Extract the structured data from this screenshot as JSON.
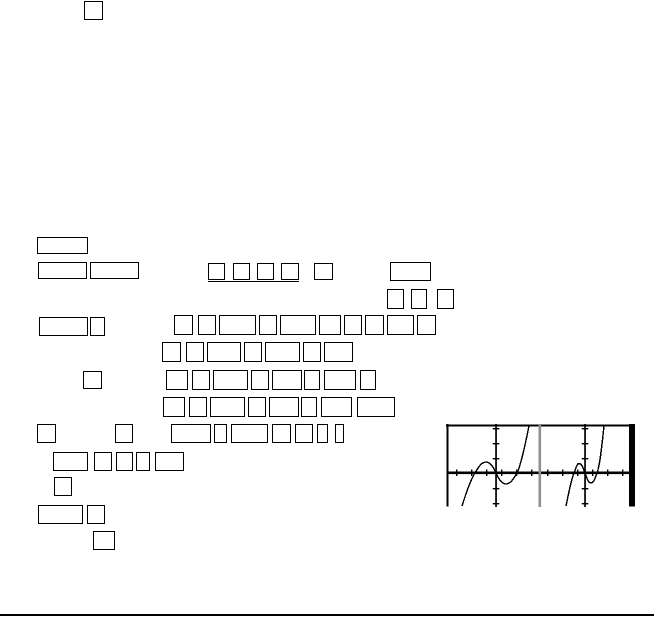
{
  "page": {
    "width": 654,
    "height": 619,
    "background": "#ffffff",
    "ink_color": "#000000"
  },
  "glyph_boxes": [
    [
      84,
      1,
      19,
      19
    ],
    [
      37,
      237,
      51,
      17
    ],
    [
      38,
      262,
      49,
      17
    ],
    [
      90,
      262,
      49,
      17
    ],
    [
      208,
      263,
      17,
      17
    ],
    [
      233,
      263,
      17,
      17
    ],
    [
      257,
      263,
      17,
      17
    ],
    [
      281,
      263,
      18,
      17
    ],
    [
      314,
      263,
      19,
      17
    ],
    [
      390,
      262,
      41,
      19
    ],
    [
      387,
      289,
      17,
      20
    ],
    [
      411,
      289,
      16,
      20
    ],
    [
      437,
      289,
      17,
      20
    ],
    [
      39,
      317,
      49,
      19
    ],
    [
      90,
      317,
      15,
      19
    ],
    [
      174,
      315,
      19,
      20
    ],
    [
      198,
      315,
      18,
      20
    ],
    [
      219,
      315,
      37,
      20
    ],
    [
      259,
      315,
      18,
      20
    ],
    [
      280,
      315,
      36,
      20
    ],
    [
      319,
      315,
      22,
      20
    ],
    [
      344,
      315,
      18,
      20
    ],
    [
      365,
      315,
      19,
      20
    ],
    [
      387,
      315,
      27,
      20
    ],
    [
      417,
      315,
      19,
      20
    ],
    [
      162,
      342,
      19,
      20
    ],
    [
      186,
      342,
      18,
      20
    ],
    [
      207,
      342,
      34,
      20
    ],
    [
      244,
      342,
      18,
      20
    ],
    [
      265,
      342,
      35,
      20
    ],
    [
      303,
      342,
      18,
      20
    ],
    [
      324,
      342,
      29,
      20
    ],
    [
      83,
      371,
      19,
      18
    ],
    [
      166,
      370,
      22,
      20
    ],
    [
      192,
      370,
      18,
      20
    ],
    [
      213,
      370,
      35,
      20
    ],
    [
      251,
      370,
      18,
      20
    ],
    [
      272,
      370,
      30,
      20
    ],
    [
      304,
      370,
      16,
      20
    ],
    [
      324,
      370,
      32,
      20
    ],
    [
      360,
      370,
      16,
      20
    ],
    [
      163,
      397,
      22,
      20
    ],
    [
      189,
      397,
      18,
      20
    ],
    [
      210,
      397,
      35,
      20
    ],
    [
      248,
      397,
      18,
      20
    ],
    [
      269,
      397,
      30,
      20
    ],
    [
      301,
      397,
      16,
      20
    ],
    [
      321,
      397,
      31,
      20
    ],
    [
      357,
      397,
      38,
      20
    ],
    [
      37,
      424,
      19,
      19
    ],
    [
      115,
      424,
      18,
      19
    ],
    [
      171,
      424,
      40,
      19
    ],
    [
      214,
      424,
      13,
      19
    ],
    [
      231,
      424,
      37,
      19
    ],
    [
      272,
      424,
      19,
      19
    ],
    [
      295,
      424,
      18,
      19
    ],
    [
      317,
      424,
      11,
      19
    ],
    [
      335,
      424,
      9,
      19
    ],
    [
      53,
      452,
      35,
      19
    ],
    [
      94,
      452,
      18,
      19
    ],
    [
      116,
      452,
      17,
      19
    ],
    [
      136,
      452,
      14,
      19
    ],
    [
      155,
      452,
      29,
      19
    ],
    [
      54,
      477,
      18,
      19
    ],
    [
      38,
      505,
      45,
      19
    ],
    [
      87,
      505,
      18,
      19
    ],
    [
      93,
      531,
      22,
      19
    ]
  ],
  "underline": {
    "x": 208,
    "y": 280.6,
    "w": 91,
    "h": 1.4
  },
  "footer_rule": {
    "x": 0,
    "y": 614,
    "w": 654,
    "h": 2.2
  },
  "graph": {
    "x": 446,
    "y": 424,
    "w": 190,
    "h": 83,
    "ink": "#000000",
    "separator_color": "#8f8f8f",
    "frame": {
      "top": {
        "x": 0,
        "y": 0.5,
        "w": 189,
        "h": 2
      },
      "left": {
        "x": 0.5,
        "y": 0,
        "w": 2,
        "h": 82.5
      },
      "right_bar": {
        "x": 183,
        "y": 0,
        "w": 6,
        "h": 82.5
      }
    },
    "x_axis": {
      "x": 1,
      "y": 47.5,
      "w": 182,
      "h": 2.6,
      "ticks_x": [
        10,
        25,
        40,
        55,
        70,
        85,
        101,
        116,
        131,
        146,
        161,
        176
      ],
      "tick_y": 45.5,
      "tick_w": 1.4,
      "tick_h": 6.5
    },
    "y_axes": [
      {
        "x": 49.2
      },
      {
        "x": 138.2
      }
    ],
    "y_axis_w": 1.7,
    "y_ticks": {
      "ys": [
        4,
        19,
        34,
        64,
        79
      ],
      "w": 6.6,
      "h": 1.4
    },
    "separator": {
      "x": 92.5,
      "w": 2.6
    },
    "curve_stroke_w": 1.4,
    "curves": [
      "M16,82 C21,66 25,55 29,49 C33,42 36,38 40,38 C44,38 47,42 50,49 C53,56 56,60 60,60 C64,60 67,56 71,49 C75,41 79,22 83,2",
      "M120,82 C123,68 125,56 128,49 C130,44 131,39.5 133,39.5 C136,39.5 137,44 139,49 C141,54 142,59 145,59 C148,59 149,54 151,49 C154,42 156,20 158,2"
    ]
  },
  "chart_data": {
    "type": "line",
    "title": "",
    "xlabel": "",
    "ylabel": "",
    "legend": "none",
    "note": "Two unlabeled calculator-style cubic curves sharing one thick horizontal axis; two vertical axes with tick marks (1-unit spacing), a gray separator line between the panels, thick black right edge; bottom of image clipped.",
    "series": [
      {
        "name": "left-cubic",
        "x_intercepts_ticks": [
          -1.5,
          0,
          1.4
        ],
        "local_max_ticks": [
          -0.75,
          0.7
        ],
        "local_min_ticks": [
          0.7,
          -0.75
        ]
      },
      {
        "name": "right-cubic",
        "x_intercepts_ticks": [
          -0.75,
          0,
          0.8
        ],
        "local_max_ticks": [
          -0.4,
          0.65
        ],
        "local_min_ticks": [
          0.4,
          -0.65
        ]
      }
    ]
  }
}
